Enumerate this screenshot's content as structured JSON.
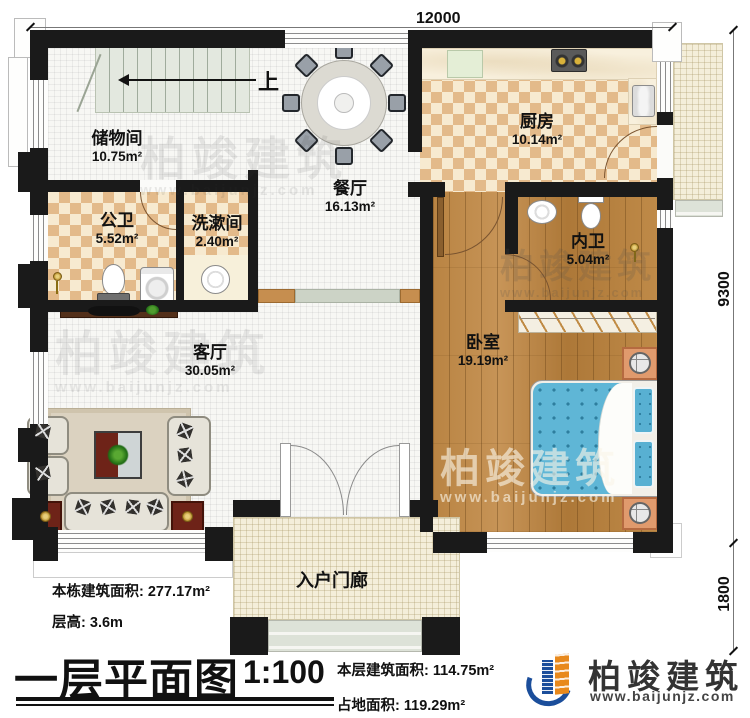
{
  "plan": {
    "title": "一层平面图",
    "scale": "1:100",
    "dims": {
      "top": "12000",
      "right_upper": "9300",
      "right_lower": "1800"
    },
    "stairs": {
      "up_label": "上"
    },
    "rooms": {
      "storage": {
        "name": "储物间",
        "area": "10.75m²"
      },
      "dining": {
        "name": "餐厅",
        "area": "16.13m²"
      },
      "kitchen": {
        "name": "厨房",
        "area": "10.14m²"
      },
      "public_bath": {
        "name": "公卫",
        "area": "5.52m²"
      },
      "washroom": {
        "name": "洗漱间",
        "area": "2.40m²"
      },
      "ensuite": {
        "name": "内卫",
        "area": "5.04m²"
      },
      "bedroom": {
        "name": "卧室",
        "area": "19.19m²"
      },
      "living": {
        "name": "客厅",
        "area": "30.05m²"
      },
      "porch": {
        "name": "入户门廊"
      }
    },
    "stats": {
      "building_area_label": "本栋建筑面积:",
      "building_area": "277.17m²",
      "floor_height_label": "层高:",
      "floor_height": "3.6m",
      "floor_area_label": "本层建筑面积:",
      "floor_area": "114.75m²",
      "footprint_label": "占地面积:",
      "footprint": "119.29m²"
    },
    "brand": {
      "name": "柏竣建筑",
      "site": "www.baijunjz.com"
    },
    "watermark": {
      "name": "柏竣建筑",
      "site": "www.baijunjz.com"
    },
    "colors": {
      "wall": "#1a1a1a",
      "brand_blue": "#1b4e9b",
      "brand_orange": "#e8891c",
      "bed_blue": "#5fb6d6",
      "wood": "#b5803f"
    }
  }
}
